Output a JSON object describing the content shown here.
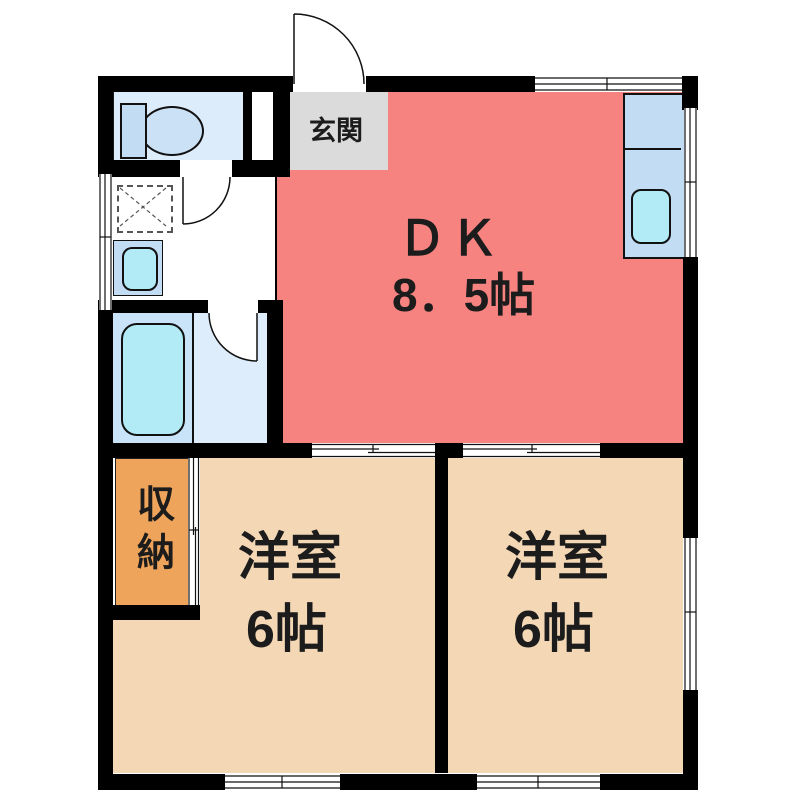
{
  "rooms": {
    "dk": {
      "label": "ＤＫ",
      "size": "8．5帖",
      "color": "#F78381"
    },
    "room_left": {
      "label": "洋室",
      "size": "6帖",
      "color": "#F4D7B4"
    },
    "room_right": {
      "label": "洋室",
      "size": "6帖",
      "color": "#F4D7B4"
    },
    "entrance": {
      "label": "玄関",
      "color": "#DBDBDB"
    },
    "storage": {
      "label": "収納",
      "color": "#EFA45B"
    }
  },
  "fixtures": [
    "toilet",
    "washing-machine-pan",
    "washbasin",
    "bathtub",
    "kitchen-counter",
    "kitchen-sink"
  ],
  "colors": {
    "wall": "#000000",
    "fixture_blue": "#C2DCF4",
    "water_cyan": "#B2EBF5",
    "toilet_floor": "#DDECFA",
    "bath_floor_left": "#C9E3F8",
    "bath_floor_right": "#DDEDFB",
    "text": "#1C1C1C"
  }
}
